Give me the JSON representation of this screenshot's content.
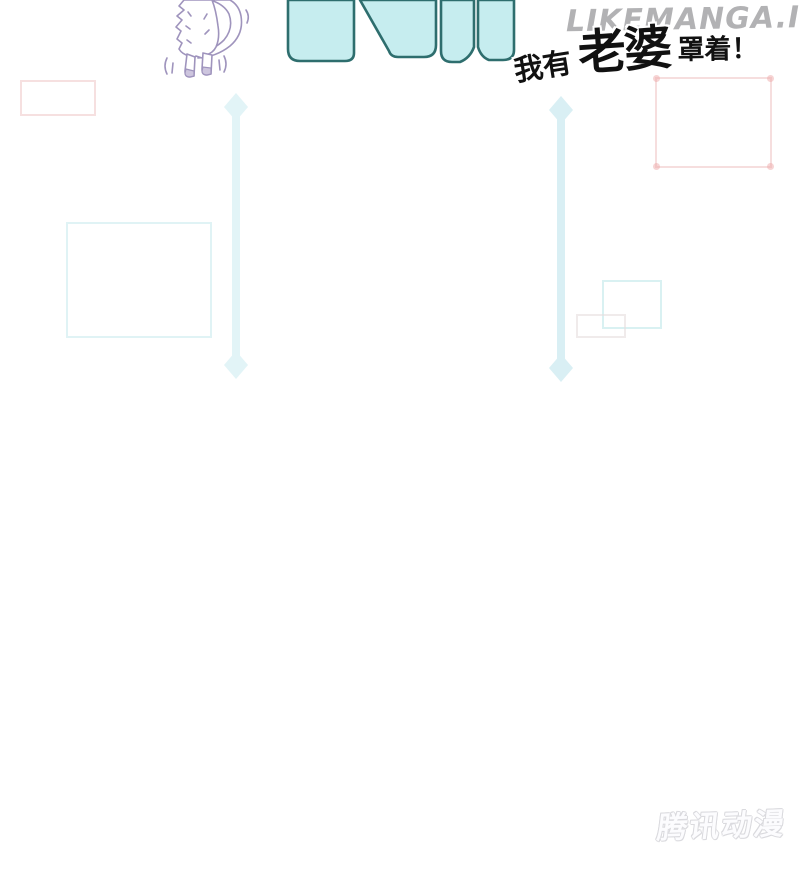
{
  "artwork": {
    "headline": {
      "prefix": "我有",
      "emphasis": "老婆",
      "suffix": "罩着！"
    },
    "watermark": "LIKEMANGA.IO",
    "publisher": "腾讯动漫"
  },
  "icons": {
    "sfx_letters": "cut-off-cyan-sfx-letters",
    "cat": "white-fluffy-cat-rear-view",
    "arrows": "vertical-double-headed-motion-arrows"
  },
  "colors": {
    "sfx_fill": "#c6edef",
    "sfx_stroke": "#2e6e6e",
    "arrow_cyan": "#d9eff4",
    "panel_pink": "#eec4c4",
    "panel_cyan": "#d6eff1",
    "panel_gray": "#e6dede",
    "cat_line": "#9f94bd",
    "logo_gray": "#dadade",
    "ink": "#111111"
  }
}
